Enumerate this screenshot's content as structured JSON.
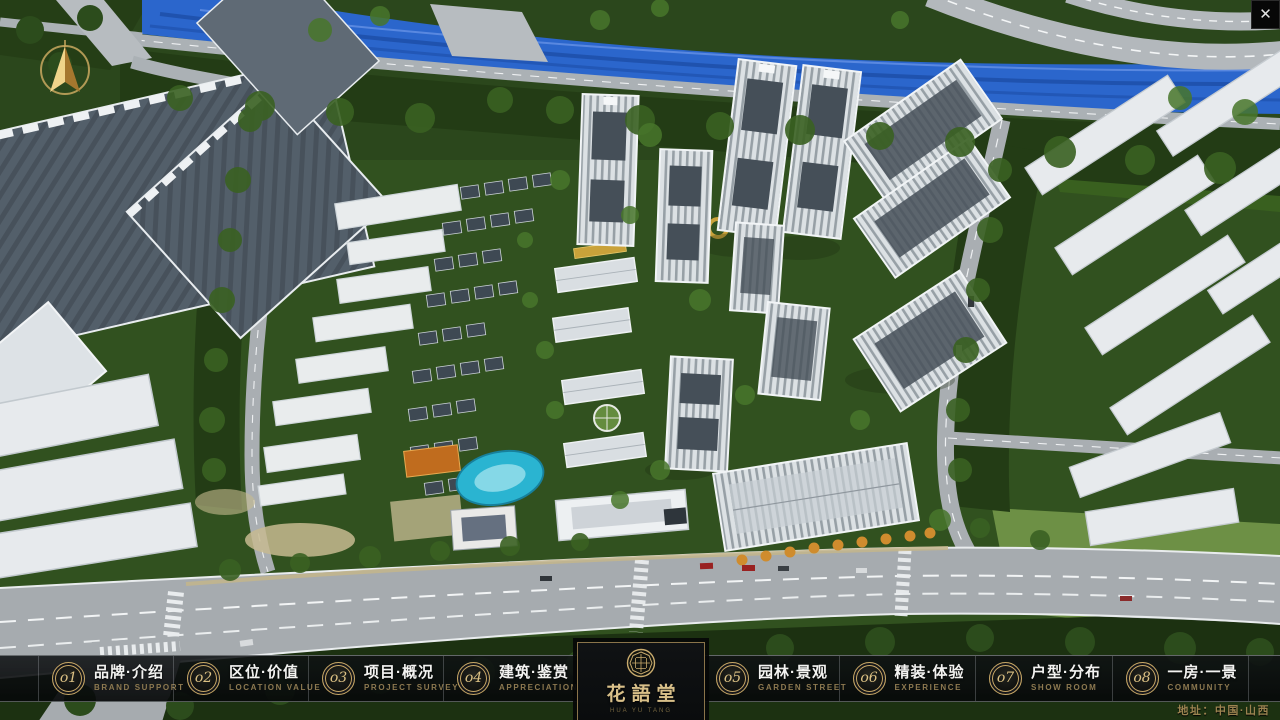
{
  "window": {
    "close_glyph": "✕"
  },
  "navbar": {
    "left_items": [
      {
        "id": "brand-intro",
        "num": "o1",
        "label": "品牌·介绍",
        "sub": "BRAND SUPPORT"
      },
      {
        "id": "location-value",
        "num": "o2",
        "label": "区位·价值",
        "sub": "LOCATION VALUE"
      },
      {
        "id": "project-overview",
        "num": "o3",
        "label": "项目·概况",
        "sub": "PROJECT SURVEY"
      },
      {
        "id": "architecture-appreciation",
        "num": "o4",
        "label": "建筑·鉴赏",
        "sub": "APPRECIATION"
      }
    ],
    "right_items": [
      {
        "id": "garden-landscape",
        "num": "o5",
        "label": "园林·景观",
        "sub": "GARDEN STREET"
      },
      {
        "id": "interior-experience",
        "num": "o6",
        "label": "精装·体验",
        "sub": "EXPERIENCE"
      },
      {
        "id": "floorplan-distribution",
        "num": "o7",
        "label": "户型·分布",
        "sub": "SHOW ROOM"
      },
      {
        "id": "one-room-one-view",
        "num": "o8",
        "label": "一房·一景",
        "sub": "COMMUNITY"
      }
    ],
    "logo": {
      "title": "花語堂",
      "subtitle": "HUA YU TANG"
    },
    "address": "地址：中国·山西"
  },
  "colors": {
    "accent_gold": "#c7a766",
    "label_white": "#f3f3f1",
    "subtitle_tan": "#8d7950",
    "river_blue": "#2b66cc"
  }
}
